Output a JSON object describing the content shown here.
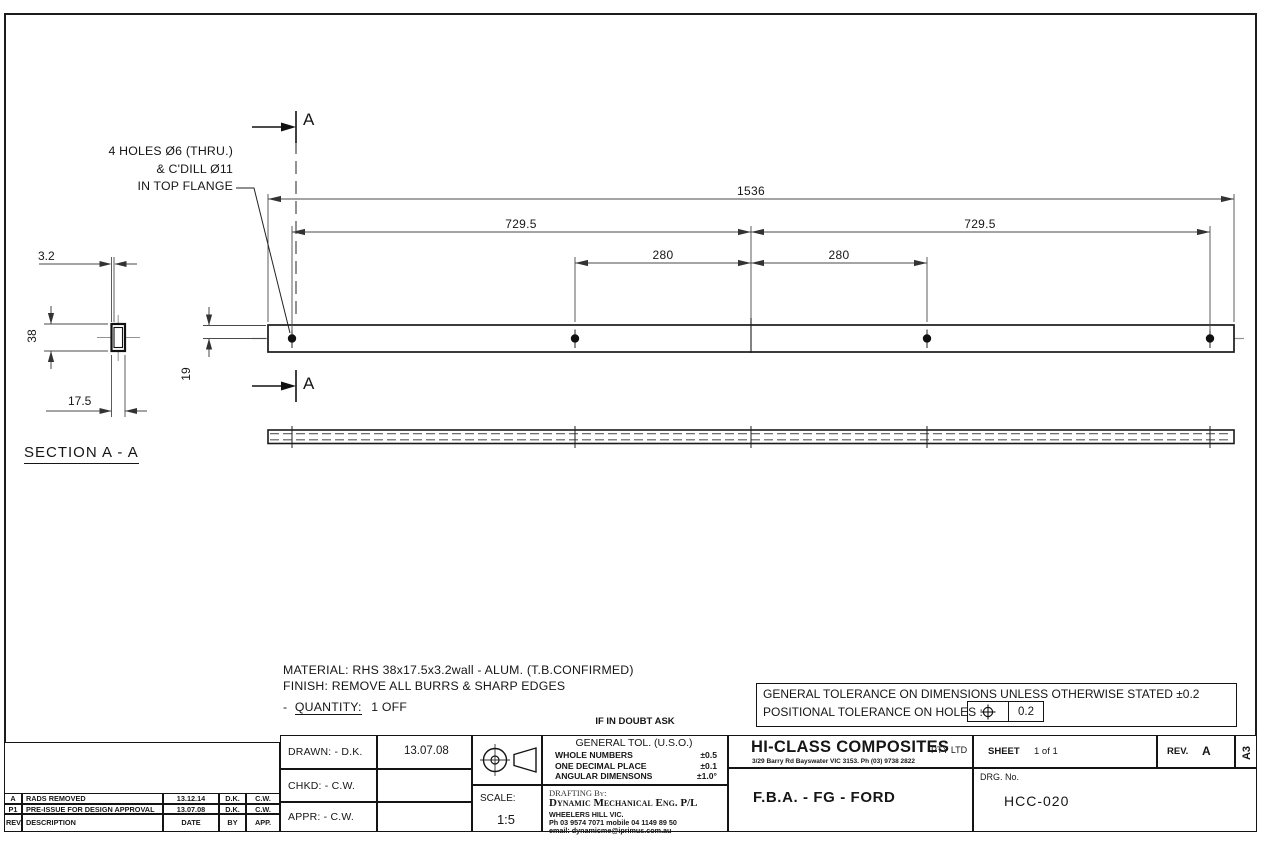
{
  "annotation": {
    "line1": "4 HOLES Ø6 (THRU.)",
    "line2": "& C'DILL Ø11",
    "line3": "IN TOP FLANGE"
  },
  "cut_marks": {
    "label": "A"
  },
  "main_view": {
    "dim_overall": "1536",
    "dim_span_left": "729.5",
    "dim_span_right": "729.5",
    "dim_hole_left": "280",
    "dim_hole_right": "280",
    "dim_edge_to_center": "19"
  },
  "section_view": {
    "dim_wall": "3.2",
    "dim_height": "38",
    "dim_width": "17.5",
    "title": "SECTION A - A"
  },
  "notes": {
    "material": "MATERIAL: RHS 38x17.5x3.2wall - ALUM. (T.B.CONFIRMED)",
    "finish": "FINISH: REMOVE ALL BURRS & SHARP EDGES",
    "quantity_prefix": "-",
    "quantity_label": "QUANTITY:",
    "quantity_value": "1 OFF",
    "doubt": "IF IN DOUBT ASK"
  },
  "tolerance_box": {
    "line1": "GENERAL TOLERANCE ON DIMENSIONS UNLESS OTHERWISE STATED ±0.2",
    "line2": "POSITIONAL TOLERANCE ON HOLES :",
    "positional_value": "0.2"
  },
  "title_block": {
    "drawn_label": "DRAWN: - D.K.",
    "drawn_date": "13.07.08",
    "chkd_label": "CHKD: - C.W.",
    "appr_label": "APPR: - C.W.",
    "scale_label": "SCALE:",
    "scale_value": "1:5",
    "general_tol": {
      "title": "GENERAL TOL. (U.S.O.)",
      "rows": [
        {
          "label": "WHOLE NUMBERS",
          "value": "±0.5"
        },
        {
          "label": "ONE DECIMAL PLACE",
          "value": "±0.1"
        },
        {
          "label": "ANGULAR DIMENSONS",
          "value": "±1.0°"
        }
      ]
    },
    "drafting": {
      "label": "DRAFTING By:",
      "company": "Dynamic Mechanical Eng. P/L",
      "address": "WHEELERS HILL VIC.",
      "phone": "Ph 03 9574 7071 mobile 04 1149 89 50",
      "email": "email: dynamicme@iprimus.com.au"
    },
    "company_name": "HI-CLASS COMPOSITES",
    "company_suffix": "PTY LTD",
    "company_address": "3/29 Barry Rd Bayswater VIC 3153.  Ph (03) 9738 2822",
    "drawing_title": "F.B.A. - FG - FORD",
    "sheet_label": "SHEET",
    "sheet_value": "1 of 1",
    "rev_label": "REV.",
    "rev_value": "A",
    "paper_size": "A3",
    "drg_label": "DRG. No.",
    "drg_value": "HCC-020"
  },
  "revision_table": {
    "rows": [
      {
        "rev": "A",
        "description": "RADS REMOVED",
        "date": "13.12.14",
        "by": "D.K.",
        "app": "C.W."
      },
      {
        "rev": "P1",
        "description": "PRE-ISSUE FOR DESIGN APPROVAL",
        "date": "13.07.08",
        "by": "D.K.",
        "app": "C.W."
      }
    ],
    "header": {
      "rev": "REV.",
      "description": "DESCRIPTION",
      "date": "DATE",
      "by": "BY",
      "app": "APP."
    }
  },
  "icons": {
    "projection": "third-angle-projection",
    "position_tolerance": "position-tolerance-crosshair"
  },
  "colors": {
    "object_line": "#1b1b1b",
    "dimension_line": "#4a4a4a",
    "centerline": "#949494",
    "background": "#ffffff"
  }
}
